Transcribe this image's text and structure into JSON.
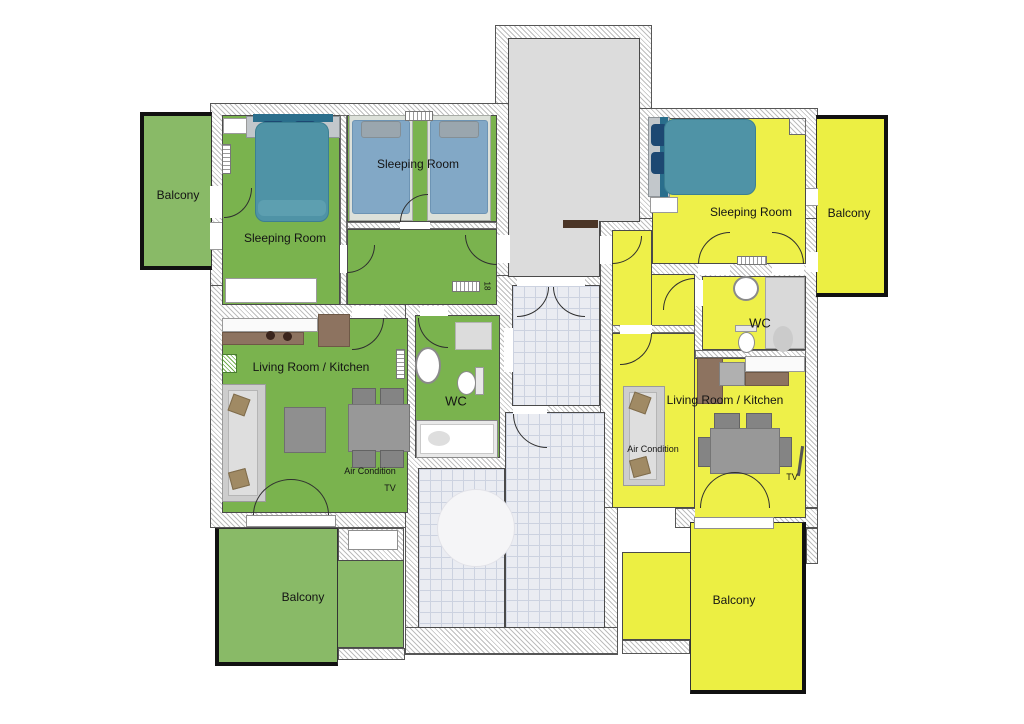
{
  "colors": {
    "left_floor": "#7ab34e",
    "left_balcony": "#89ba67",
    "right_floor": "#eef049",
    "right_balcony": "#ecef43",
    "stair_floor": "#dcdcdc",
    "double_bed": "#4f93a6",
    "single_bed": "#82a8c6"
  },
  "left_apartment": {
    "balcony_top_label": "Balcony",
    "sleeping_room_1_label": "Sleeping Room",
    "sleeping_room_2_label": "Sleeping Room",
    "living_room_label": "Living Room / Kitchen",
    "wc_label": "WC",
    "air_condition_label": "Air Condition",
    "tv_label": "TV",
    "balcony_bottom_label": "Balcony",
    "radiator_label": "18"
  },
  "right_apartment": {
    "balcony_top_label": "Balcony",
    "sleeping_room_label": "Sleeping Room",
    "living_room_label": "Living Room / Kitchen",
    "wc_label": "WC",
    "air_condition_label": "Air Condition",
    "tv_label": "TV",
    "balcony_bottom_label": "Balcony"
  }
}
